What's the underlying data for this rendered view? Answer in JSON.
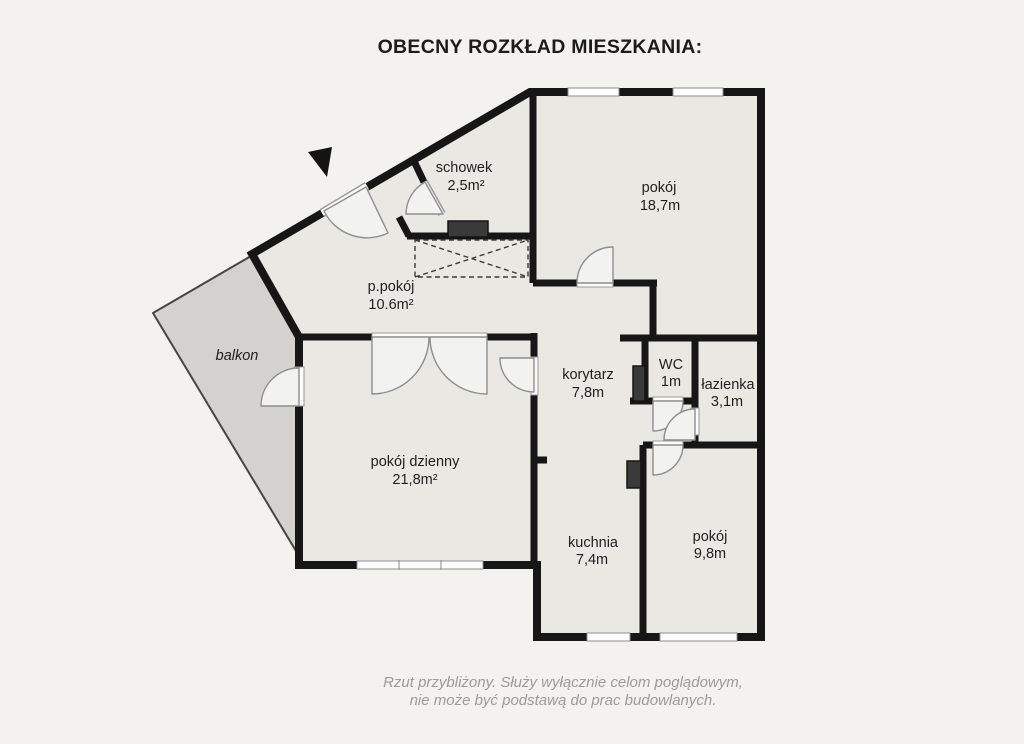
{
  "title": "OBECNY ROZKŁAD MIESZKANIA:",
  "rooms": {
    "schowek": {
      "name": "schowek",
      "area": "2,5m²"
    },
    "pokoj_gorny": {
      "name": "pokój",
      "area": "18,7m"
    },
    "p_pokoj": {
      "name": "p.pokój",
      "area": "10.6m²"
    },
    "balkon": {
      "name": "balkon"
    },
    "korytarz": {
      "name": "korytarz",
      "area": "7,8m"
    },
    "wc": {
      "name": "WC",
      "area": "1m"
    },
    "lazienka": {
      "name": "łazienka",
      "area": "3,1m"
    },
    "pokoj_dzienny": {
      "name": "pokój dzienny",
      "area": "21,8m²"
    },
    "kuchnia": {
      "name": "kuchnia",
      "area": "7,4m"
    },
    "pokoj_dolny": {
      "name": "pokój",
      "area": "9,8m"
    }
  },
  "footer": {
    "line1": "Rzut przybliżony. Służy wyłącznie celom poglądowym,",
    "line2": "nie może być podstawą do prac budowlanych."
  },
  "colors": {
    "background": "#f3f2ee",
    "floor": "#e9e8e3",
    "balcony": "#d3d2ce",
    "wall": "#161616",
    "shaft": "#3a3a3a"
  }
}
